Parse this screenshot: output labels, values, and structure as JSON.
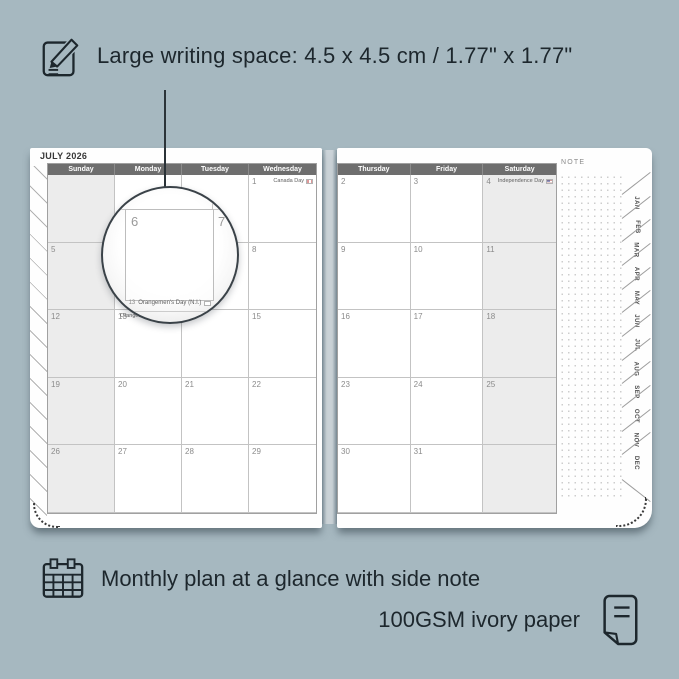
{
  "colors": {
    "background": "#a6b8c0",
    "ink": "#1d272d",
    "header_bar": "#6e6e6e",
    "weekend_shade": "#ececec",
    "page": "#fefefe"
  },
  "top_annotation": {
    "icon": "note-pencil-icon",
    "text": "Large writing space: 4.5 x 4.5 cm / 1.77\" x 1.77\""
  },
  "bottom_annotation": {
    "line1": "Monthly plan at a glance with side note",
    "line1_icon": "calendar-grid-icon",
    "line2": "100GSM ivory paper",
    "line2_icon": "paper-icon"
  },
  "planner": {
    "month_title": "JULY 2026",
    "note_label": "NOTE",
    "weekday_headers_left": [
      "Sunday",
      "Monday",
      "Tuesday",
      "Wednesday"
    ],
    "weekday_headers_right": [
      "Thursday",
      "Friday",
      "Saturday"
    ],
    "left_rows": [
      [
        "",
        "",
        "",
        "1"
      ],
      [
        "5",
        "6",
        "7",
        "8"
      ],
      [
        "12",
        "13",
        "14",
        "15"
      ],
      [
        "19",
        "20",
        "21",
        "22"
      ],
      [
        "26",
        "27",
        "28",
        "29"
      ]
    ],
    "right_rows": [
      [
        "2",
        "3",
        "4"
      ],
      [
        "9",
        "10",
        "11"
      ],
      [
        "16",
        "17",
        "18"
      ],
      [
        "23",
        "24",
        "25"
      ],
      [
        "30",
        "31",
        ""
      ]
    ],
    "holidays": [
      {
        "page": "left",
        "row": 0,
        "col": 3,
        "label": "Canada Day",
        "flag": "CA"
      },
      {
        "page": "left",
        "row": 2,
        "col": 1,
        "label": "Orangemen's Day (N.I.)",
        "flag": ""
      },
      {
        "page": "right",
        "row": 0,
        "col": 2,
        "label": "Independence Day",
        "flag": "US"
      }
    ],
    "month_tabs": [
      "JAN",
      "FEB",
      "MAR",
      "APR",
      "MAY",
      "JUN",
      "JUL",
      "AUG",
      "SEP",
      "OCT",
      "NOV",
      "DEC"
    ],
    "magnifier": {
      "day_left": "6",
      "day_right": "7",
      "footer_day": "13",
      "footer_label": "Orangemen's Day (N.I.)"
    }
  }
}
